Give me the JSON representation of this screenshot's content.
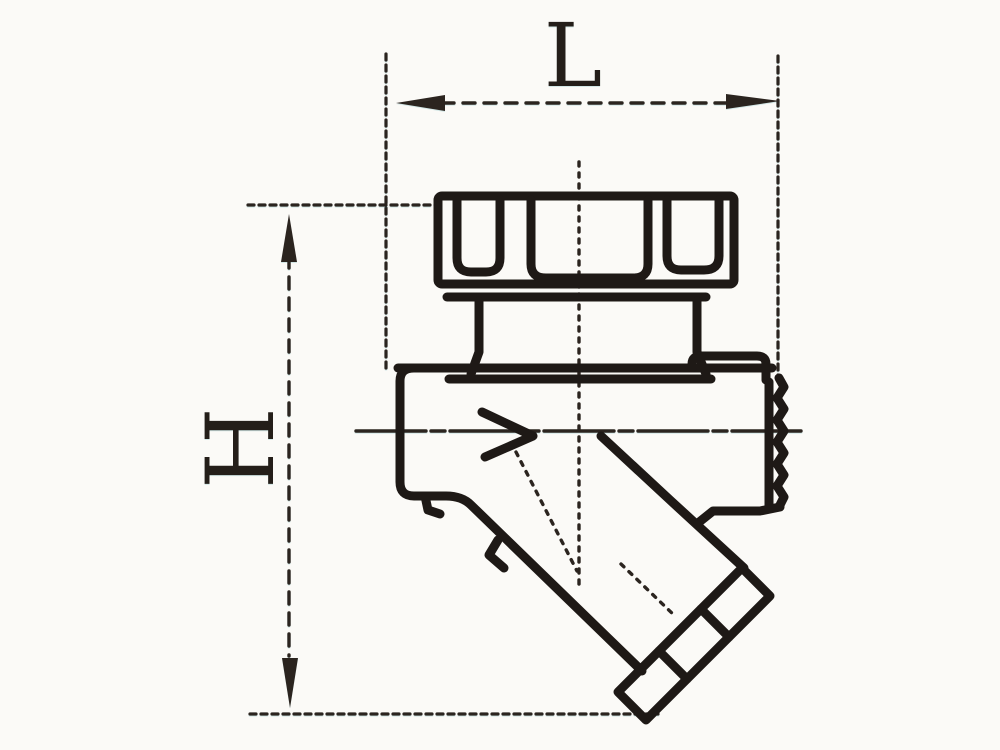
{
  "drawing": {
    "type": "technical-drawing",
    "dimensions": {
      "length_label": "L",
      "height_label": "H"
    }
  },
  "colors": {
    "ink": "#1e1916",
    "dimension_line": "#2b241f",
    "background": "#fbfaf7"
  }
}
